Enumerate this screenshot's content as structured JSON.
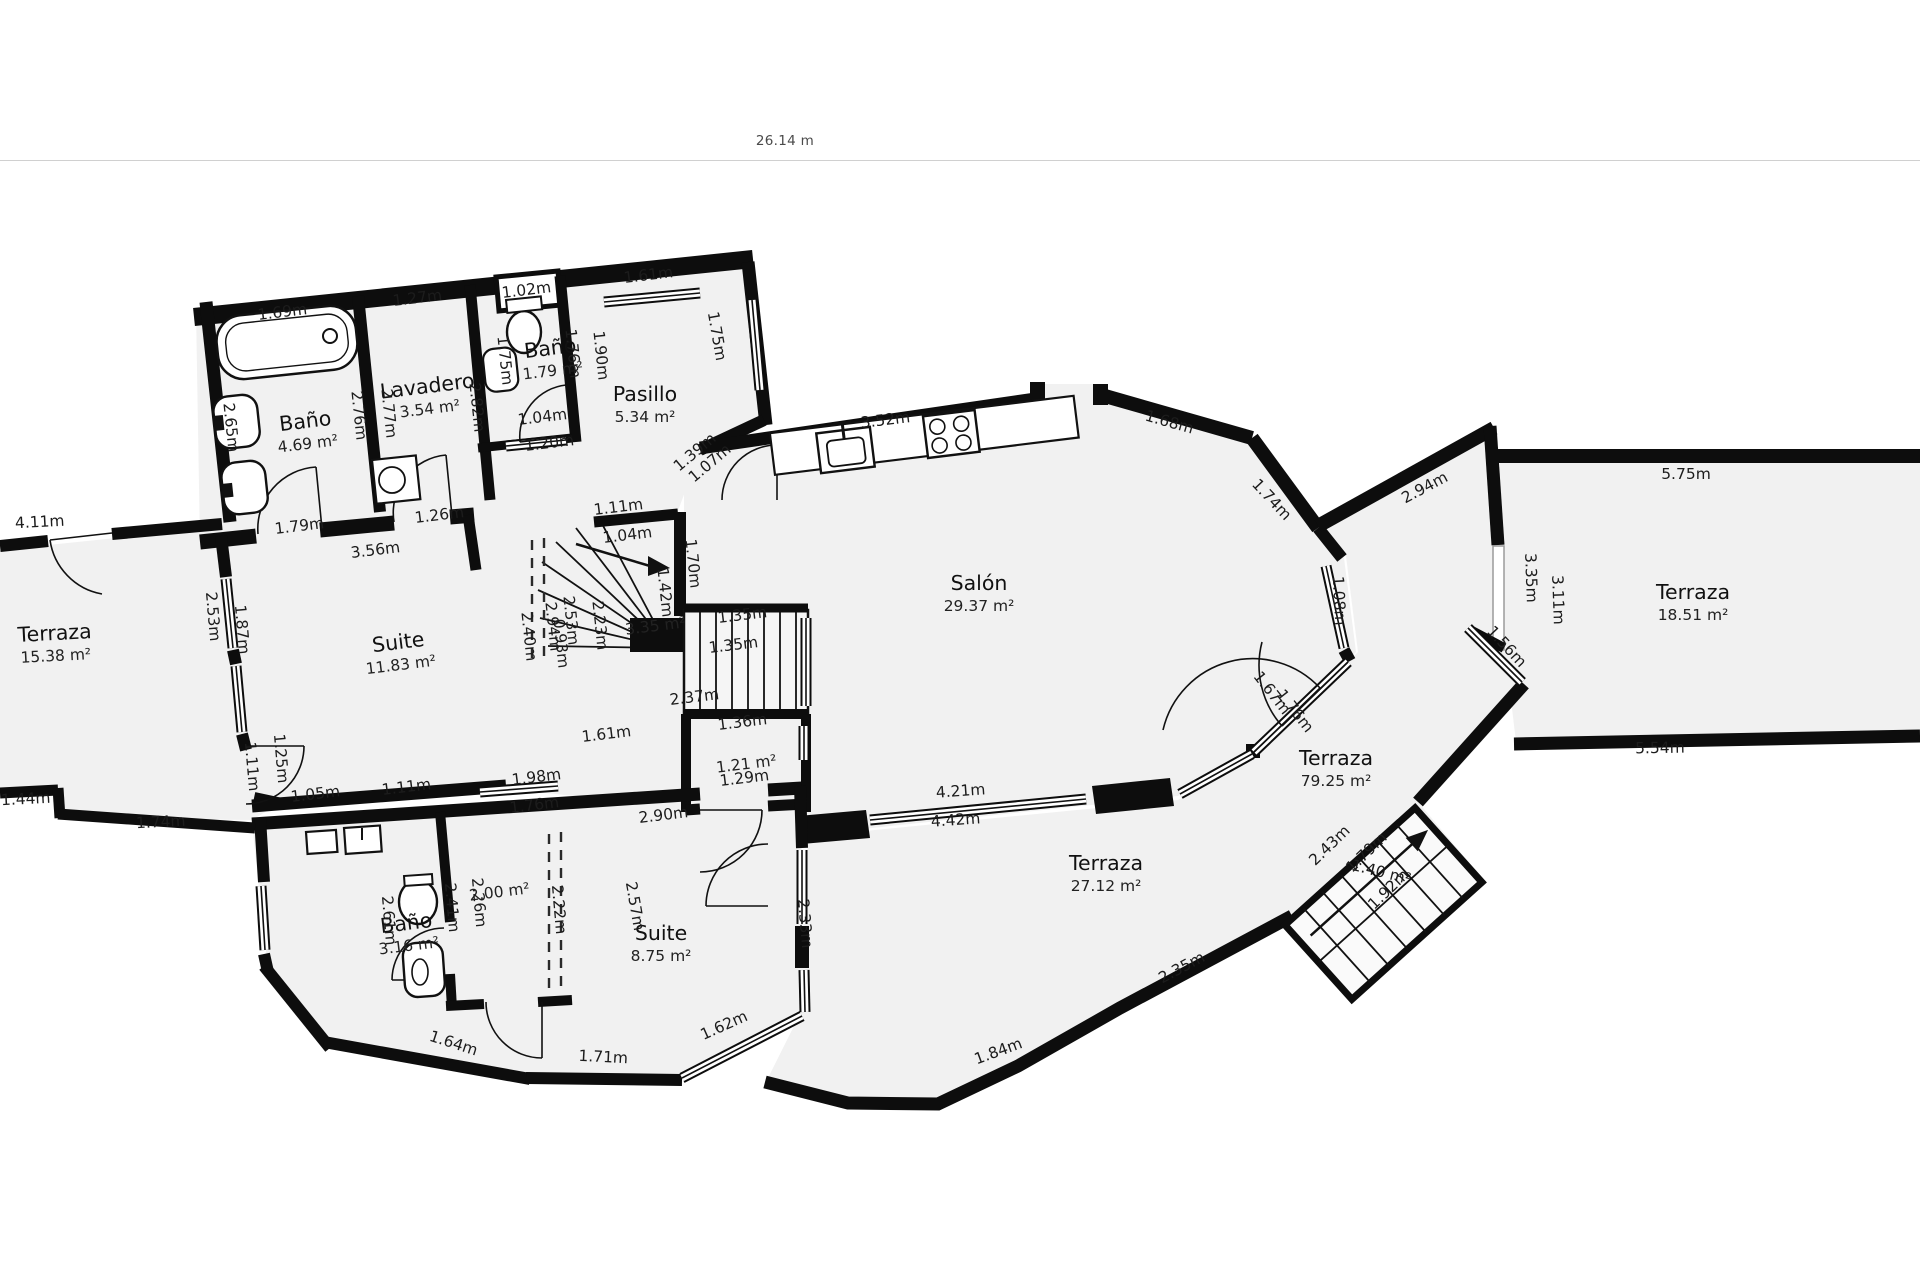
{
  "scale": {
    "label": "26.14 m"
  },
  "colors": {
    "wall": "#0d0d0d",
    "floor": "#f1f1f1",
    "background": "#ffffff"
  },
  "rooms": [
    {
      "name": "Baño",
      "area": "4.69 m²",
      "x": 306,
      "y": 428,
      "r": -7
    },
    {
      "name": "Lavadero",
      "area": "3.54 m²",
      "x": 428,
      "y": 393,
      "r": -7
    },
    {
      "name": "Baño",
      "area": "1.79 m²",
      "x": 551,
      "y": 355,
      "r": -7
    },
    {
      "name": "Pasillo",
      "area": "5.34 m²",
      "x": 645,
      "y": 401,
      "r": 0
    },
    {
      "name": "Salón",
      "area": "29.37 m²",
      "x": 979,
      "y": 590,
      "r": 0
    },
    {
      "name": "Suite",
      "area": "11.83 m²",
      "x": 399,
      "y": 649,
      "r": -7
    },
    {
      "name": "Terraza",
      "area": "15.38 m²",
      "x": 55,
      "y": 640,
      "r": -3
    },
    {
      "name": "Terraza",
      "area": "18.51 m²",
      "x": 1693,
      "y": 599,
      "r": 0
    },
    {
      "name": "Terraza",
      "area": "79.25 m²",
      "x": 1336,
      "y": 765,
      "r": 0
    },
    {
      "name": "Terraza",
      "area": "27.12 m²",
      "x": 1106,
      "y": 870,
      "r": 0
    },
    {
      "name": "Suite",
      "area": "8.75 m²",
      "x": 661,
      "y": 940,
      "r": 0
    },
    {
      "name": "Baño",
      "area": "3.16 m²",
      "x": 407,
      "y": 930,
      "r": -7
    },
    {
      "name": "",
      "area": "3.35 m²",
      "x": 656,
      "y": 631,
      "r": -7
    },
    {
      "name": "",
      "area": "1.21 m²",
      "x": 747,
      "y": 769,
      "r": -7
    },
    {
      "name": "",
      "area": "2.00 m²",
      "x": 500,
      "y": 897,
      "r": -7
    }
  ],
  "measurements": [
    {
      "t": "1.69m",
      "x": 283,
      "y": 317,
      "r": -7
    },
    {
      "t": "1.27m",
      "x": 418,
      "y": 303,
      "r": -7
    },
    {
      "t": "1.02m",
      "x": 527,
      "y": 295,
      "r": -7
    },
    {
      "t": "1.61m",
      "x": 649,
      "y": 280,
      "r": -7
    },
    {
      "t": "2.65m",
      "x": 226,
      "y": 428,
      "r": 84
    },
    {
      "t": "2.76m",
      "x": 354,
      "y": 416,
      "r": 84
    },
    {
      "t": "2.77m",
      "x": 384,
      "y": 414,
      "r": 84
    },
    {
      "t": "2.82m",
      "x": 472,
      "y": 408,
      "r": 84
    },
    {
      "t": "1.75m",
      "x": 500,
      "y": 361,
      "r": 84
    },
    {
      "t": "1.76m",
      "x": 568,
      "y": 354,
      "r": 84
    },
    {
      "t": "1.90m",
      "x": 596,
      "y": 356,
      "r": 84
    },
    {
      "t": "1.75m",
      "x": 712,
      "y": 337,
      "r": 80
    },
    {
      "t": "1.79m",
      "x": 300,
      "y": 531,
      "r": -7
    },
    {
      "t": "1.26m",
      "x": 440,
      "y": 520,
      "r": -7
    },
    {
      "t": "1.04m",
      "x": 543,
      "y": 422,
      "r": -7
    },
    {
      "t": "1.20m",
      "x": 550,
      "y": 448,
      "r": -7
    },
    {
      "t": "1.39m",
      "x": 698,
      "y": 456,
      "r": -40
    },
    {
      "t": "1.07m",
      "x": 713,
      "y": 467,
      "r": -40
    },
    {
      "t": "3.56m",
      "x": 376,
      "y": 555,
      "r": -7
    },
    {
      "t": "3.52m",
      "x": 886,
      "y": 425,
      "r": -7
    },
    {
      "t": "1.68m",
      "x": 1168,
      "y": 427,
      "r": 16
    },
    {
      "t": "1.74m",
      "x": 1268,
      "y": 503,
      "r": 47
    },
    {
      "t": "2.94m",
      "x": 1427,
      "y": 492,
      "r": -28
    },
    {
      "t": "1.08m",
      "x": 1334,
      "y": 601,
      "r": 87
    },
    {
      "t": "1.67m",
      "x": 1268,
      "y": 696,
      "r": 52
    },
    {
      "t": "1.76m",
      "x": 1291,
      "y": 714,
      "r": 52
    },
    {
      "t": "4.21m",
      "x": 961,
      "y": 796,
      "r": -4
    },
    {
      "t": "4.42m",
      "x": 956,
      "y": 825,
      "r": -4
    },
    {
      "t": "3.35m",
      "x": 1526,
      "y": 578,
      "r": 88
    },
    {
      "t": "3.11m",
      "x": 1553,
      "y": 600,
      "r": 88
    },
    {
      "t": "5.75m",
      "x": 1686,
      "y": 479,
      "r": 0
    },
    {
      "t": "5.54m",
      "x": 1660,
      "y": 753,
      "r": -1
    },
    {
      "t": "1.56m",
      "x": 1503,
      "y": 650,
      "r": 47
    },
    {
      "t": "1.11m",
      "x": 619,
      "y": 512,
      "r": -7
    },
    {
      "t": "1.04m",
      "x": 628,
      "y": 540,
      "r": -7
    },
    {
      "t": "1.70m",
      "x": 688,
      "y": 564,
      "r": 84
    },
    {
      "t": "1.42m",
      "x": 660,
      "y": 593,
      "r": 84
    },
    {
      "t": "2.23m",
      "x": 595,
      "y": 626,
      "r": 84
    },
    {
      "t": "2.53m",
      "x": 566,
      "y": 621,
      "r": 84
    },
    {
      "t": "2.94m",
      "x": 548,
      "y": 627,
      "r": 84
    },
    {
      "t": "0.93m",
      "x": 556,
      "y": 644,
      "r": 84
    },
    {
      "t": "2.40m",
      "x": 524,
      "y": 637,
      "r": 84
    },
    {
      "t": "1.35m",
      "x": 743,
      "y": 620,
      "r": -7
    },
    {
      "t": "1.35m",
      "x": 734,
      "y": 650,
      "r": -7
    },
    {
      "t": "2.37m",
      "x": 695,
      "y": 702,
      "r": -7
    },
    {
      "t": "1.36m",
      "x": 743,
      "y": 727,
      "r": -7
    },
    {
      "t": "1.61m",
      "x": 607,
      "y": 739,
      "r": -7
    },
    {
      "t": "1.29m",
      "x": 745,
      "y": 783,
      "r": -7
    },
    {
      "t": "2.53m",
      "x": 208,
      "y": 617,
      "r": 85
    },
    {
      "t": "1.87m",
      "x": 237,
      "y": 630,
      "r": 85
    },
    {
      "t": "4.11m",
      "x": 40,
      "y": 527,
      "r": -3
    },
    {
      "t": "1.11m",
      "x": 247,
      "y": 767,
      "r": 85
    },
    {
      "t": "1.25m",
      "x": 276,
      "y": 759,
      "r": 85
    },
    {
      "t": "1.05m",
      "x": 316,
      "y": 799,
      "r": -7
    },
    {
      "t": "1.11m",
      "x": 407,
      "y": 792,
      "r": -7
    },
    {
      "t": "1.98m",
      "x": 537,
      "y": 782,
      "r": -7
    },
    {
      "t": "1.76m",
      "x": 535,
      "y": 810,
      "r": -7
    },
    {
      "t": "1.44m",
      "x": 26,
      "y": 804,
      "r": -3
    },
    {
      "t": "1.74m",
      "x": 161,
      "y": 827,
      "r": -3
    },
    {
      "t": "2.90m",
      "x": 664,
      "y": 820,
      "r": -7
    },
    {
      "t": "2.61m",
      "x": 384,
      "y": 921,
      "r": 85
    },
    {
      "t": "2.41m",
      "x": 447,
      "y": 908,
      "r": 85
    },
    {
      "t": "2.26m",
      "x": 474,
      "y": 903,
      "r": 85
    },
    {
      "t": "2.22m",
      "x": 554,
      "y": 910,
      "r": 85
    },
    {
      "t": "2.57m",
      "x": 630,
      "y": 907,
      "r": 80
    },
    {
      "t": "2.33m",
      "x": 800,
      "y": 924,
      "r": 85
    },
    {
      "t": "1.64m",
      "x": 452,
      "y": 1048,
      "r": 18
    },
    {
      "t": "1.71m",
      "x": 603,
      "y": 1062,
      "r": 3
    },
    {
      "t": "1.62m",
      "x": 726,
      "y": 1030,
      "r": -24
    },
    {
      "t": "1.84m",
      "x": 1000,
      "y": 1056,
      "r": -20
    },
    {
      "t": "2.35m",
      "x": 1184,
      "y": 972,
      "r": -28
    },
    {
      "t": "2.43m",
      "x": 1333,
      "y": 849,
      "r": -44
    },
    {
      "t": "1.79m",
      "x": 1370,
      "y": 856,
      "r": -44
    },
    {
      "t": "1.40 m²",
      "x": 1380,
      "y": 877,
      "r": 14
    },
    {
      "t": "1.92m",
      "x": 1392,
      "y": 893,
      "r": -44
    }
  ]
}
